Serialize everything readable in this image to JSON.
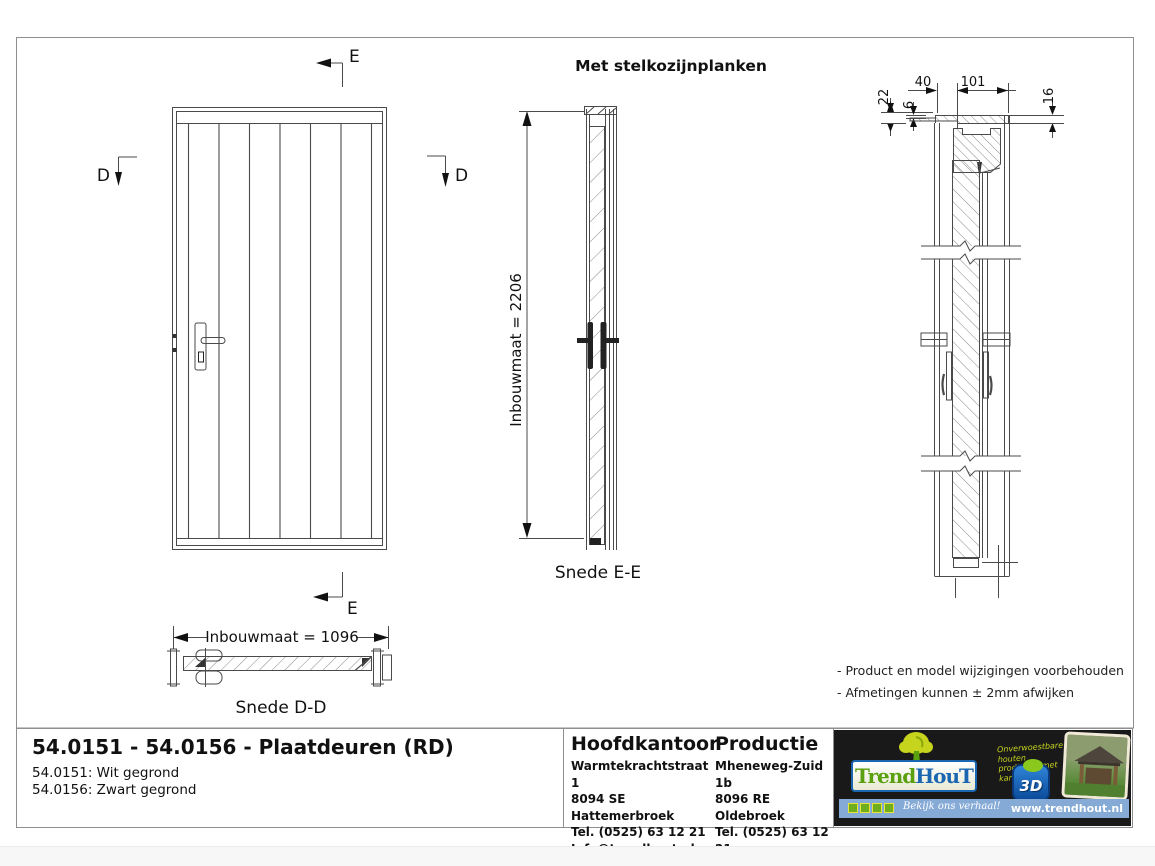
{
  "sheet": {
    "drawing_title": "Met stelkozijnplanken",
    "markers": {
      "d": "D",
      "e": "E"
    },
    "snede_ee": {
      "label": "Snede E-E",
      "dimension": "Inbouwmaat = 2206"
    },
    "snede_dd": {
      "label": "Snede D-D",
      "dimension": "Inbouwmaat = 1096"
    },
    "detail_dims": {
      "d40": "40",
      "d101": "101",
      "d22": "22",
      "d6": "6",
      "d16": "16"
    },
    "notes": [
      "- Product en model wijzigingen voorbehouden",
      "- Afmetingen kunnen ± 2mm afwijken"
    ]
  },
  "title_block": {
    "title": "54.0151 - 54.0156 - Plaatdeuren (RD)",
    "variants": [
      "54.0151: Wit gegrond",
      "54.0156: Zwart gegrond"
    ],
    "hoofdkantoor": {
      "heading": "Hoofdkantoor",
      "lines": [
        "Warmtekrachtstraat 1",
        "8094 SE Hattemerbroek",
        "Tel. (0525) 63 12 21",
        "Info@trendhout.nl"
      ]
    },
    "productie": {
      "heading": "Productie",
      "lines": [
        "Mheneweg-Zuid 1b",
        "8096 RE Oldebroek",
        "Tel. (0525) 63 12 21",
        "Info@trendhout.nl"
      ]
    }
  },
  "logo_panel": {
    "brand_trend": "Trend",
    "brand_hout": "HouT",
    "tagline": "Onverwoestbare houten producten met karakter",
    "badge_3d": "3D",
    "cta": "Bekijk ons verhaal!",
    "website": "www.trendhout.nl",
    "colors": {
      "panel": "#191919",
      "bar": "#85aad6",
      "green": "#5aa00f",
      "lime": "#c6d41e",
      "blue": "#1a66b0"
    }
  }
}
